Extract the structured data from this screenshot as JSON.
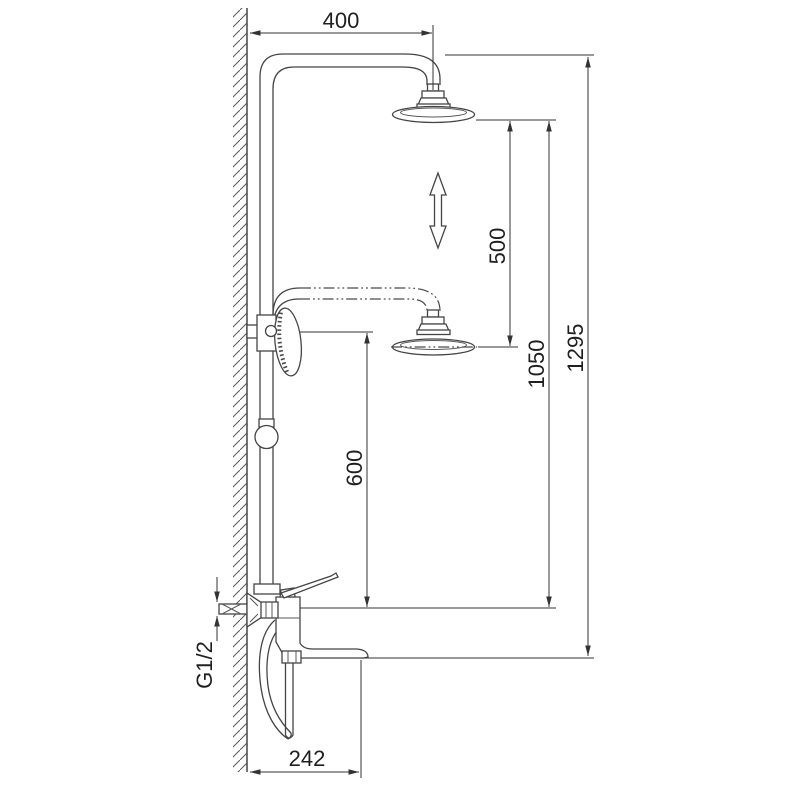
{
  "drawing": {
    "background": "#ffffff",
    "line_color": "#454545",
    "dimension_color": "#333333",
    "icons": {
      "height_adjust": "double-arrow-up-down",
      "wall_section": "diagonal-hatch"
    }
  },
  "dimensions": {
    "arm_projection": "400",
    "height_adjustment": "500",
    "head_height": "1050",
    "total_height": "1295",
    "handshower_height": "600",
    "inlet_thread": "G1/2",
    "spout_projection": "242"
  }
}
